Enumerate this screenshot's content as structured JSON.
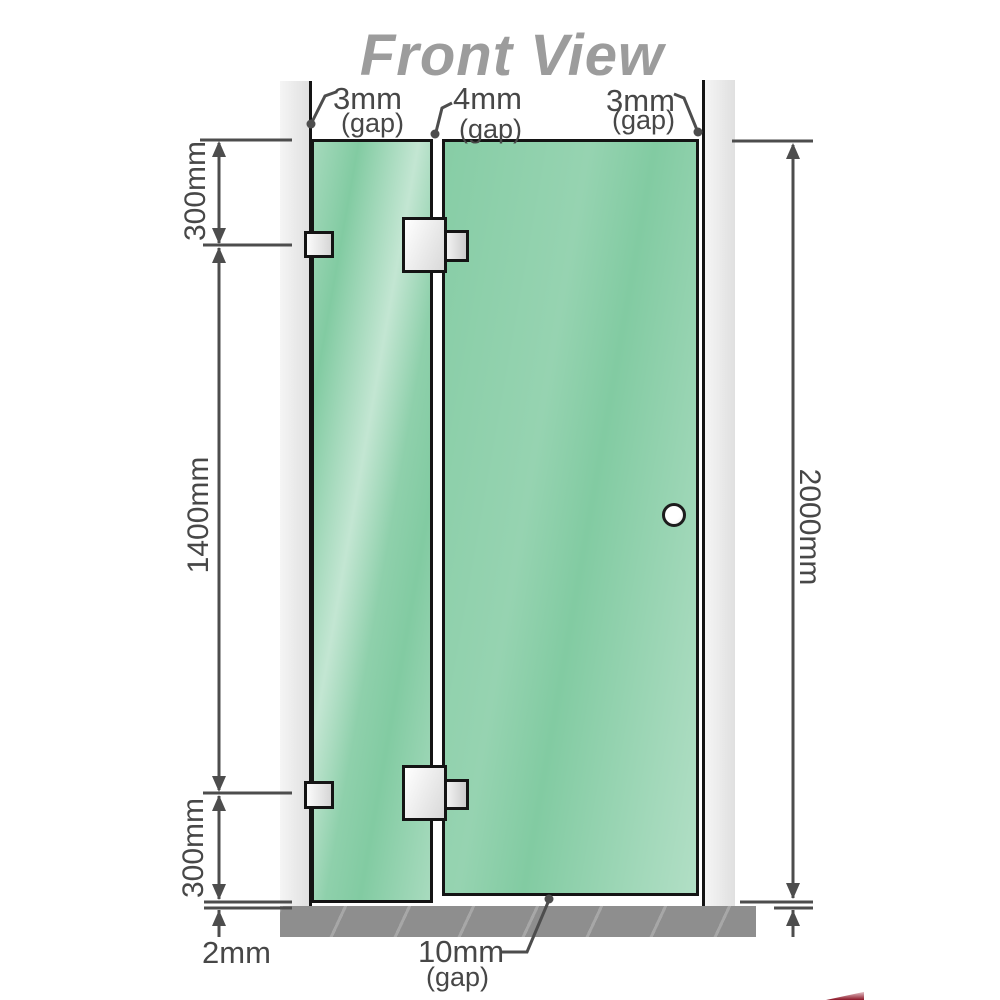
{
  "title": "Front View",
  "dimensions": {
    "gap_top_left": "3mm",
    "gap_top_left_note": "(gap)",
    "gap_top_center": "4mm",
    "gap_top_center_note": "(gap)",
    "gap_top_right": "3mm",
    "gap_top_right_note": "(gap)",
    "left_upper": "300mm",
    "left_middle": "1400mm",
    "left_lower": "300mm",
    "right_total": "2000mm",
    "floor_clearance": "2mm",
    "door_bottom_gap": "10mm",
    "door_bottom_gap_note": "(gap)"
  },
  "colors": {
    "glass": "#82cba2",
    "wall": "#e9e9e9",
    "floor": "#8e8e8e",
    "line": "#4d4d4d",
    "label": "#474747",
    "title": "#9c9c9c",
    "outline": "#141414",
    "corner-red": "#8c1627"
  }
}
